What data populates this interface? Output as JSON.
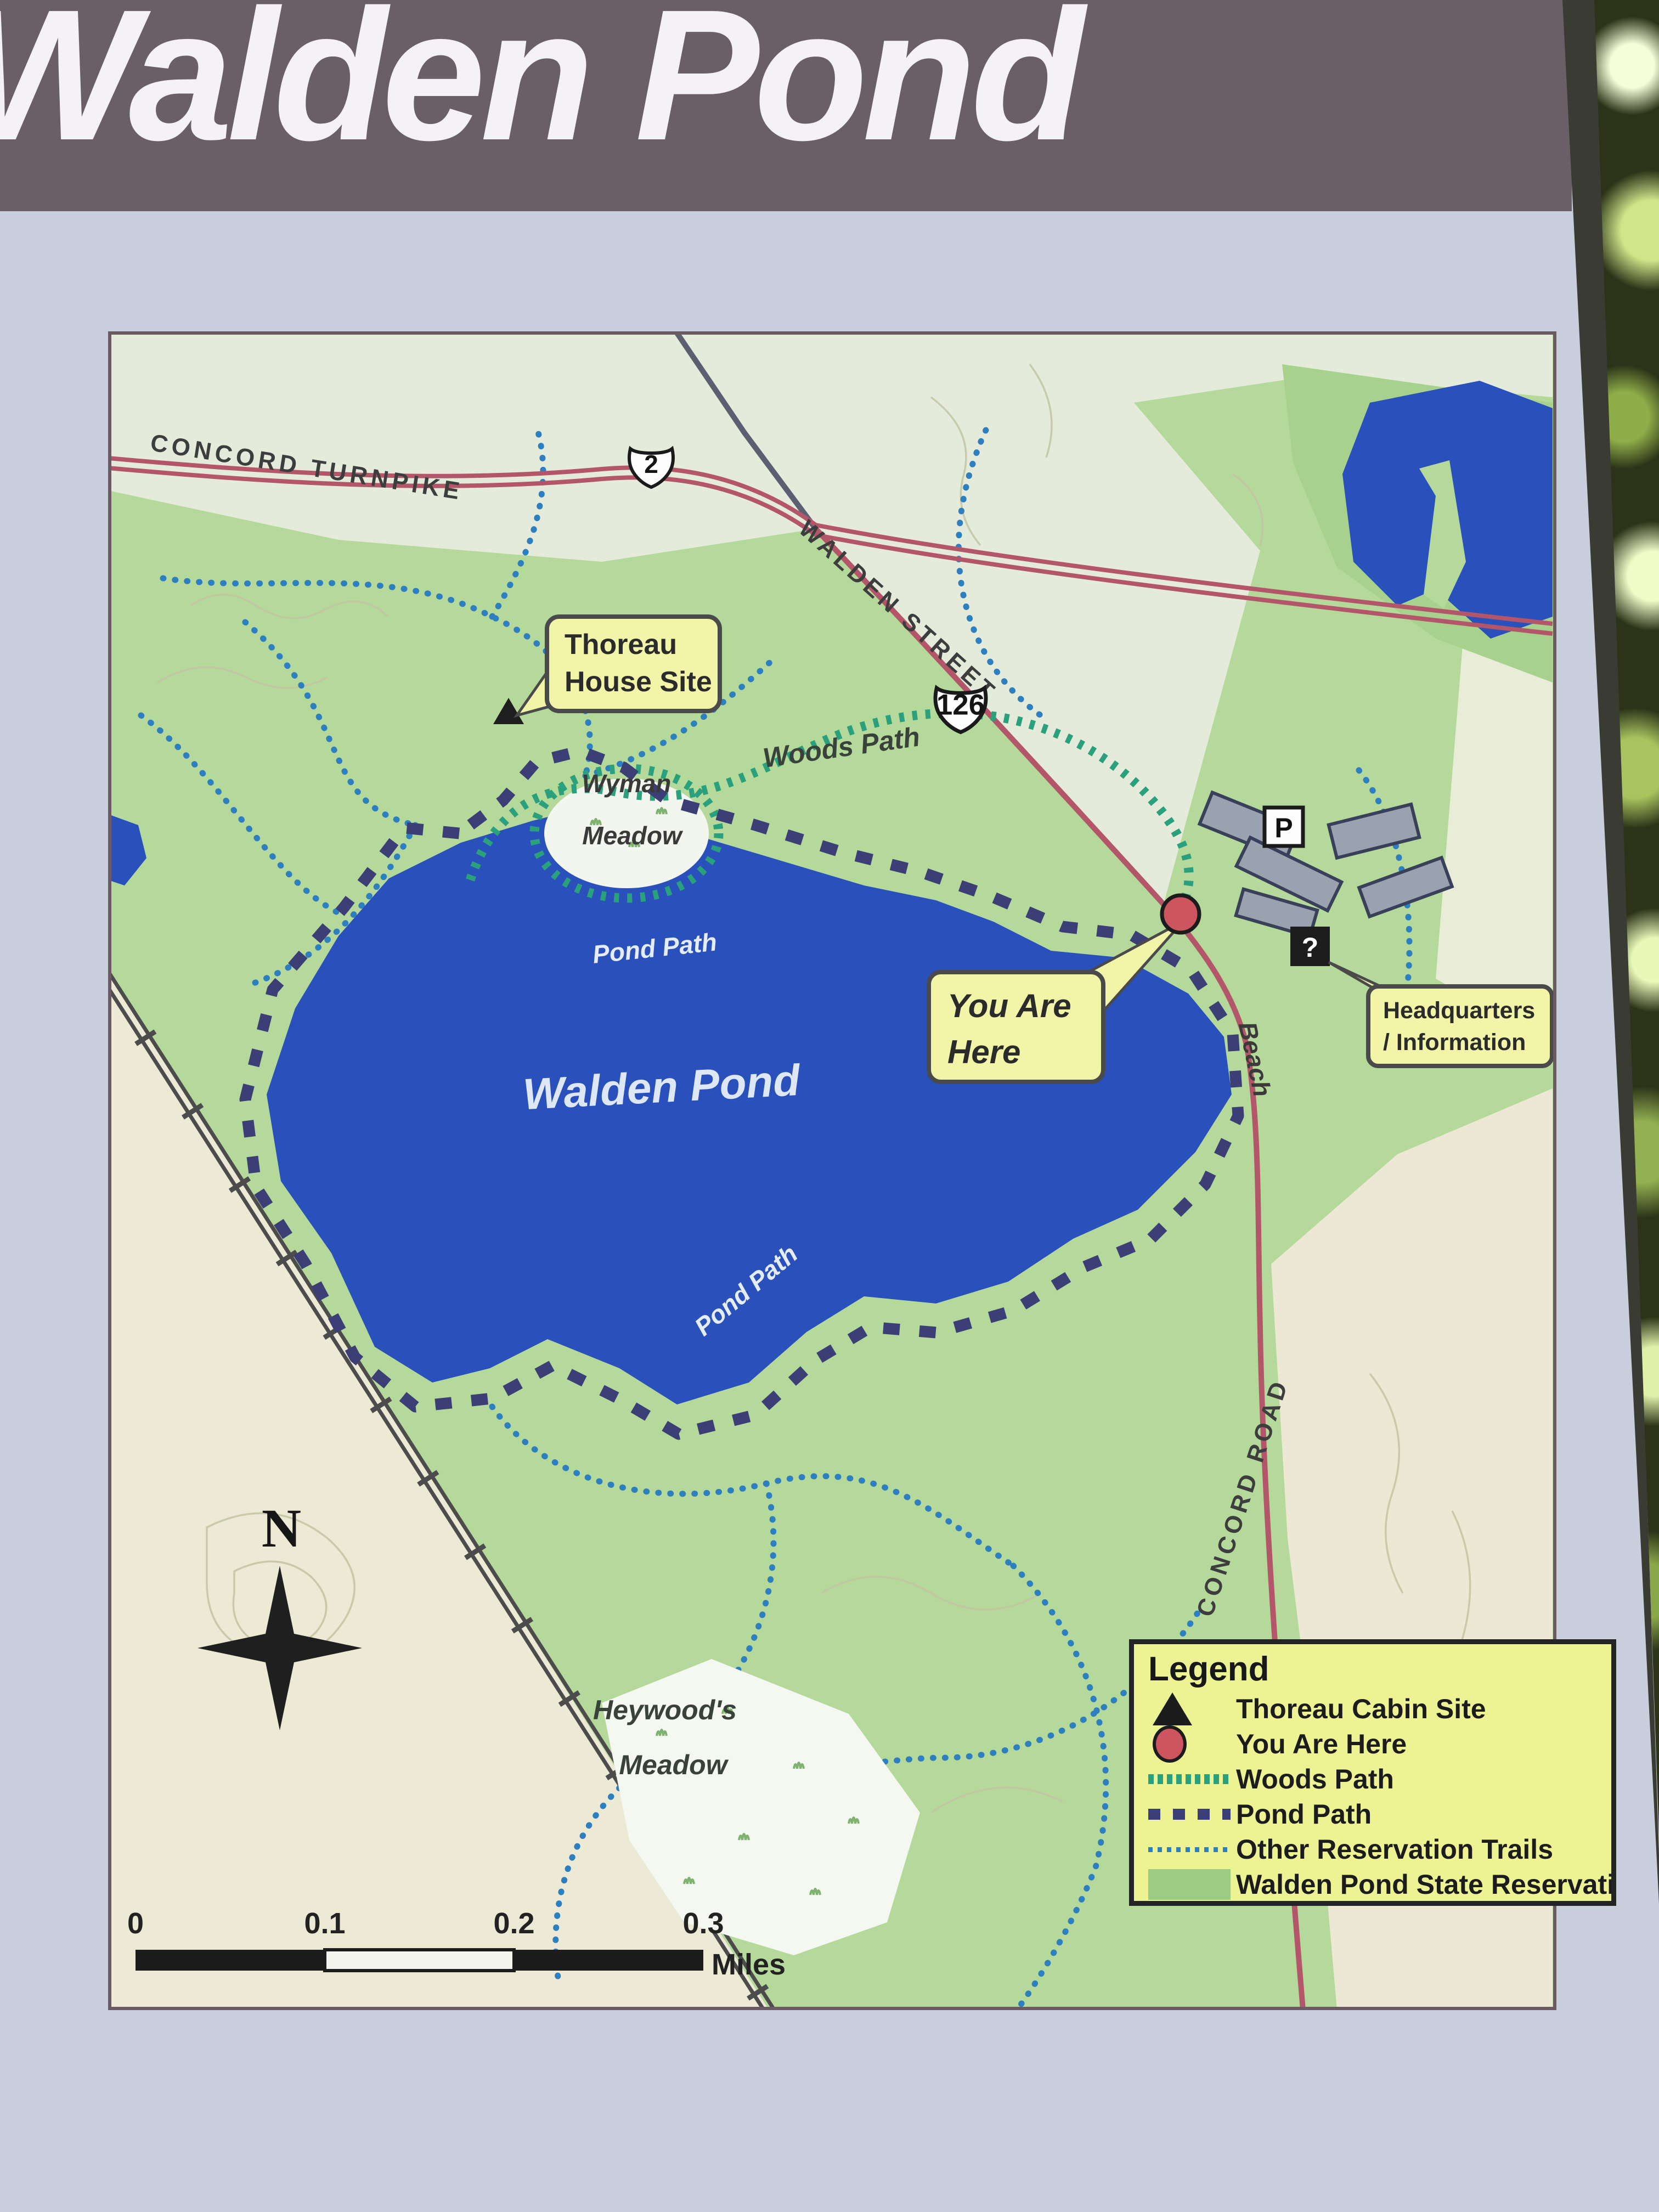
{
  "sign": {
    "title": "Walden Pond"
  },
  "map": {
    "roads": {
      "concord_turnpike": "CONCORD TURNPIKE",
      "walden_street": "WALDEN STREET",
      "concord_road": "CONCORD ROAD",
      "route_2": "2",
      "route_126": "126"
    },
    "labels": {
      "walden_pond": "Walden Pond",
      "pond_path_north": "Pond Path",
      "pond_path_south": "Pond Path",
      "woods_path": "Woods Path",
      "wyman_line1": "Wyman",
      "wyman_line2": "Meadow",
      "heywoods_line1": "Heywood's",
      "heywoods_line2": "Meadow",
      "beach": "Beach",
      "compass_north": "N"
    },
    "callouts": {
      "thoreau": {
        "line1": "Thoreau",
        "line2": "House Site"
      },
      "you_are_here": {
        "line1": "You Are",
        "line2": "Here"
      },
      "headquarters": {
        "line1": "Headquarters",
        "line2": "/ Information"
      }
    },
    "icons": {
      "parking": "P",
      "information": "?"
    },
    "scale": {
      "ticks": [
        "0",
        "0.1",
        "0.2",
        "0.3"
      ],
      "unit": "Miles"
    }
  },
  "legend": {
    "title": "Legend",
    "items": [
      {
        "symbol": "cabin-triangle",
        "label": "Thoreau Cabin Site"
      },
      {
        "symbol": "red-circle",
        "label": "You Are Here"
      },
      {
        "symbol": "green-dash",
        "label": "Woods Path"
      },
      {
        "symbol": "navy-dash",
        "label": "Pond Path"
      },
      {
        "symbol": "blue-dotted",
        "label": "Other Reservation Trails"
      },
      {
        "symbol": "green-fill",
        "label": "Walden Pond State Reservation"
      }
    ]
  },
  "colors": {
    "banner": "#6a5f67",
    "pond_blue": "#2950bb",
    "reservation_green": "#b5d99b",
    "legend_yellow": "#edf293",
    "callout_yellow": "#f2f5a8",
    "woods_path_teal": "#2aa17c",
    "pond_path_navy": "#3c3f75",
    "trail_blue": "#2e7fc0",
    "road_red": "#b4566a",
    "you_are_here_red": "#cd5560"
  }
}
